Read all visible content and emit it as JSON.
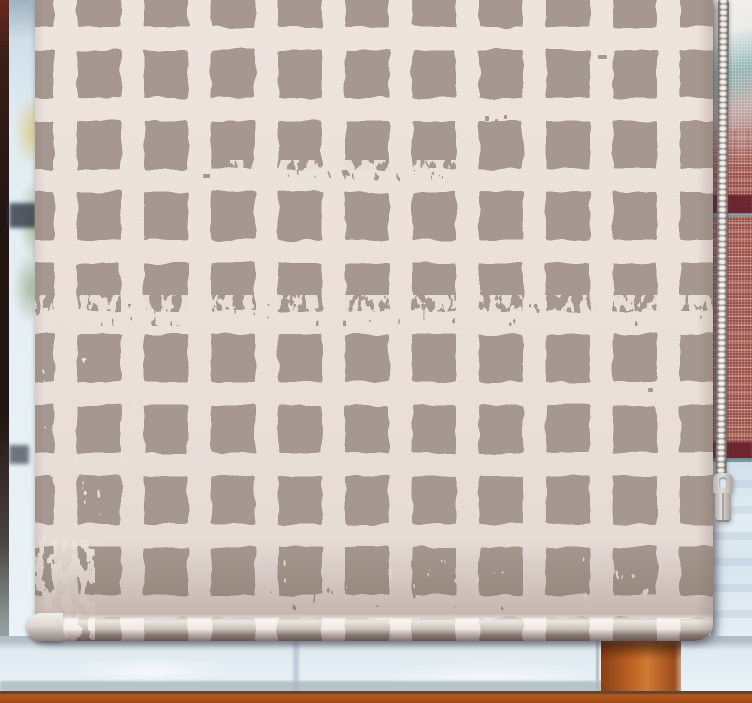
{
  "scene": {
    "type": "photograph",
    "subject": "Roller blind with hand-painted check grid pattern lowered over a window",
    "setting": "Frosted winter window; orange-brown wooden frame and sill; red brick wall and window screen visible outside on the right; foliage glimpsed on the left",
    "visible_text": ""
  },
  "blind": {
    "pattern_name": "hand-drawn check / grid squares with distressed grunge patches",
    "construction": "roller blind rolled onto a bottom bar with rounded end caps",
    "grid": {
      "columns_visible": 10,
      "rows_visible": 9,
      "square_w_px": 44,
      "square_h_px": 48,
      "gap_px": 23
    }
  },
  "chain": {
    "type": "ball pull chain",
    "side": "right",
    "connector": "plastic chain joiner with eyelet hole"
  },
  "colors": {
    "blind_bg": "#ece2dc",
    "blind_square": "#a69890",
    "roll_highlight": "#fdf9f5",
    "roll_shadow": "#3f2d24",
    "roll_cap_dark": "#a39a93",
    "chain_bead": "#f2efec",
    "chain_bead_shadow": "#8f8883",
    "connector": "#e2deda",
    "glass_frost": "#dce8f0",
    "mesh_white": "#f2eeec",
    "teal_reflection": "#8fb5b4",
    "teal_line": "#6f9aa4",
    "brick": "#9e5047",
    "band_maroon": "#6d2530",
    "wood_orange": "#c26727",
    "wood_orange_dark": "#8a3f16",
    "sill_orange": "#b55a1e",
    "sill_line": "#5d4436",
    "sill_gray": "#a9b9bd",
    "left_frame": "#241511",
    "left_frame_red": "#6a2820",
    "left_frame_fade": "#aebabb",
    "glass_dark_band": "#39404e",
    "foliage_yellow": "#d8c57c",
    "foliage_green": "#93a36b"
  }
}
